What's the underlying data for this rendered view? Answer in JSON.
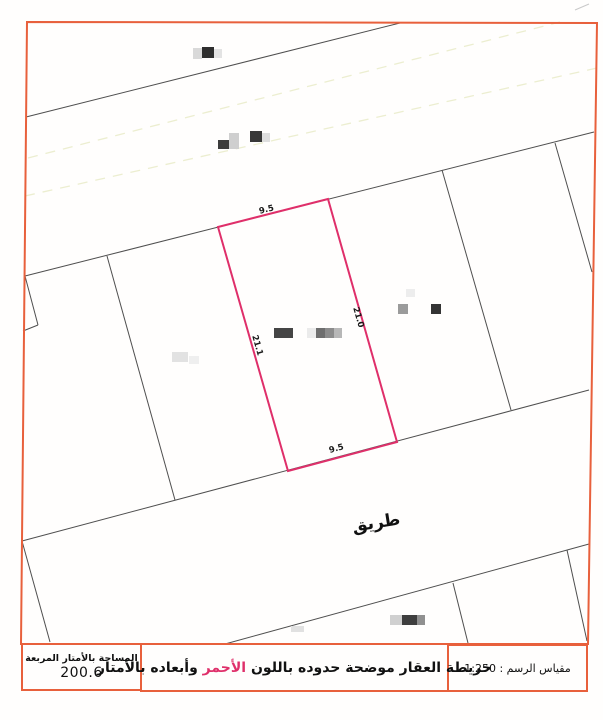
{
  "road_label": "طريق",
  "plot": {
    "dim_top": "9.5",
    "dim_right": "21.0",
    "dim_left": "21.1",
    "dim_bottom": "9.5"
  },
  "footer": {
    "area_label": "المساحة بالأمتار المربعة",
    "area_value": "200.6",
    "legend_prefix": "خريطة العقار موضحة حدوده باللون ",
    "legend_highlight": "الأحمر",
    "legend_suffix": " وأبعاده بالأمتار",
    "scale_label": "مقياس الرسم :",
    "scale_value": "1:250"
  },
  "colors": {
    "frame": "#e8603c",
    "plot_outline": "#df2f6a",
    "parcel_line": "#4f4f4f",
    "dashed_line": "#eceed0",
    "highlight_text": "#df2f6a"
  }
}
